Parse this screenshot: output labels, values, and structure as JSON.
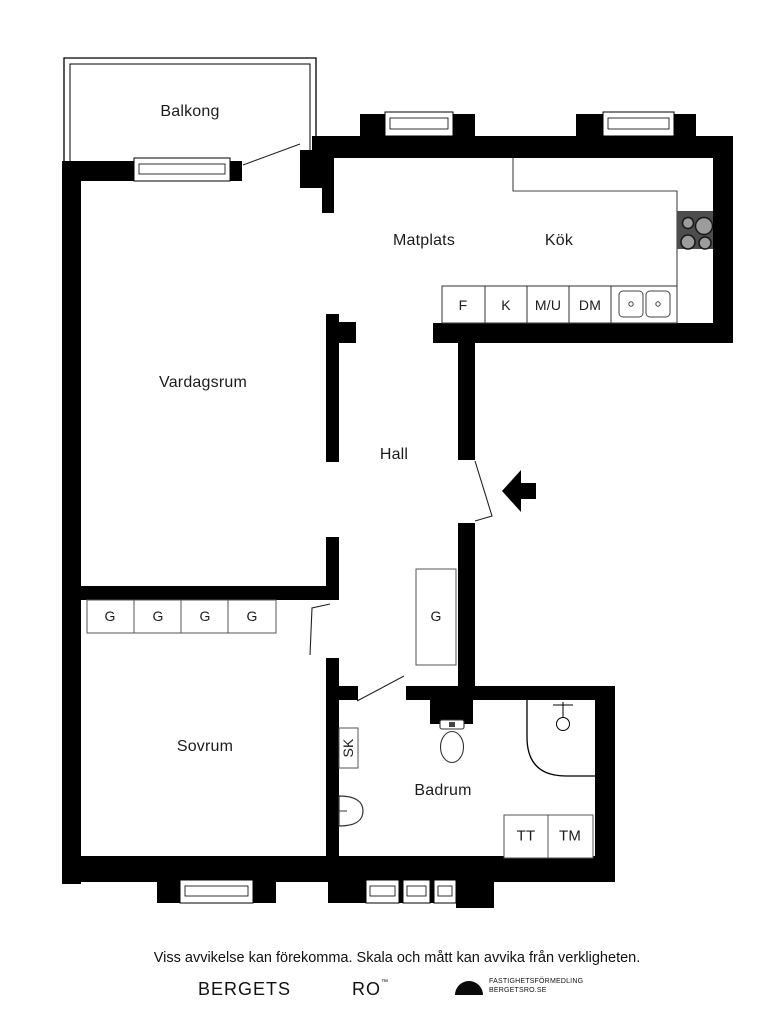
{
  "plan": {
    "rooms": {
      "balcony": "Balkong",
      "dining": "Matplats",
      "kitchen": "Kök",
      "living": "Vardagsrum",
      "hall": "Hall",
      "bedroom": "Sovrum",
      "bathroom": "Badrum"
    },
    "kitchen_units": [
      "F",
      "K",
      "M/U",
      "DM"
    ],
    "bedroom_wardrobes": [
      "G",
      "G",
      "G",
      "G"
    ],
    "hall_wardrobe": "G",
    "bathroom_units": {
      "cleaning_closet": "SK",
      "dryer": "TT",
      "washer": "TM"
    },
    "colors": {
      "wall": "#000000",
      "fixture_line": "#111111",
      "stove_body": "#4d4d4d",
      "stove_burner": "#9c9c9c"
    }
  },
  "footer": {
    "disclaimer": "Viss avvikelse kan förekomma. Skala och mått kan avvika från verkligheten.",
    "brand_left": "BERGETS",
    "brand_right": "RO",
    "brand_tm": "™",
    "brand_line1": "FASTIGHETSFÖRMEDLING",
    "brand_line2": "BERGETSRO.SE"
  }
}
